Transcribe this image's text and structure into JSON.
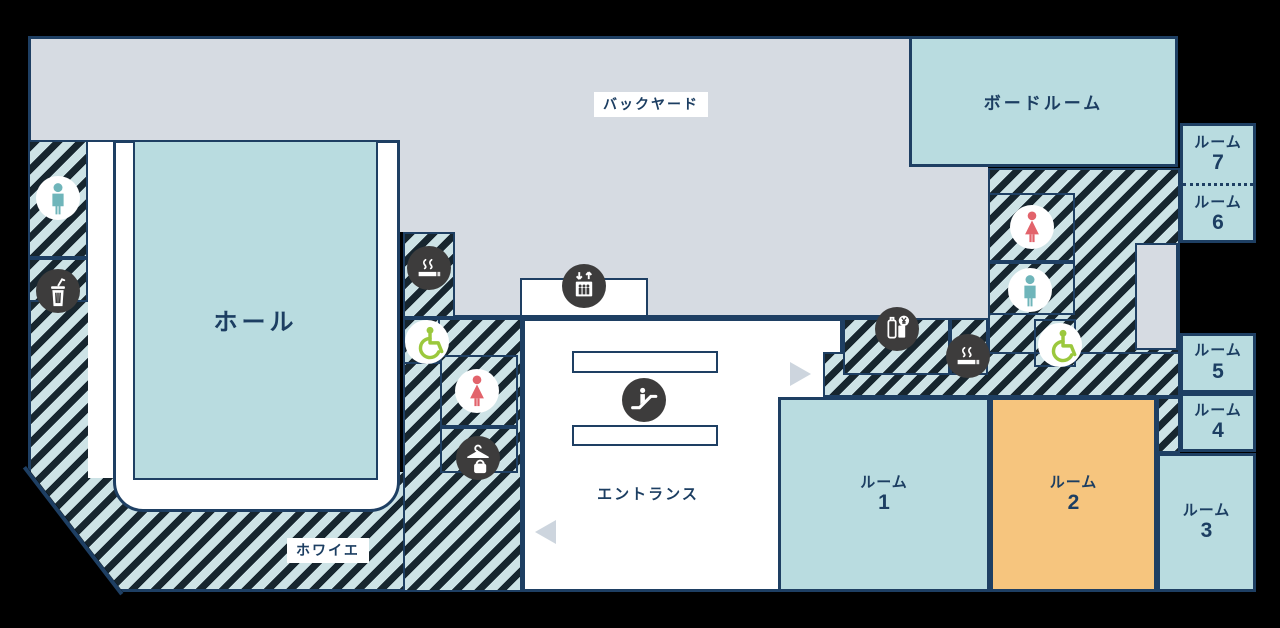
{
  "areas": {
    "backyard": "バックヤード",
    "boardroom": "ボードルーム",
    "hall": "ホール",
    "foyer": "ホワイエ",
    "entrance": "エントランス"
  },
  "rooms": [
    {
      "label": "ルーム",
      "number": "1"
    },
    {
      "label": "ルーム",
      "number": "2"
    },
    {
      "label": "ルーム",
      "number": "3"
    },
    {
      "label": "ルーム",
      "number": "4"
    },
    {
      "label": "ルーム",
      "number": "5"
    },
    {
      "label": "ルーム",
      "number": "6"
    },
    {
      "label": "ルーム",
      "number": "7"
    }
  ],
  "icons": [
    {
      "name": "mens-toilet-icon",
      "glyph": "man-figure",
      "color": "#6fb5ba"
    },
    {
      "name": "womens-toilet-icon",
      "glyph": "woman-figure",
      "color": "#e2636b"
    },
    {
      "name": "accessible-icon",
      "glyph": "wheelchair",
      "color": "#9bc83d"
    },
    {
      "name": "trash-icon",
      "glyph": "trash-can-with-straw",
      "color": "#ffffff"
    },
    {
      "name": "smoking-icon",
      "glyph": "cigarette-with-smoke",
      "color": "#ffffff"
    },
    {
      "name": "vending-machine-icon",
      "glyph": "bottle-can-yen",
      "color": "#ffffff"
    },
    {
      "name": "cloakroom-icon",
      "glyph": "hanger-and-bag",
      "color": "#ffffff"
    },
    {
      "name": "elevator-icon",
      "glyph": "elevator-cab-arrows",
      "color": "#ffffff"
    },
    {
      "name": "escalator-icon",
      "glyph": "escalator-person",
      "color": "#ffffff"
    },
    {
      "name": "arrow-right-icon",
      "glyph": "triangle-right",
      "color": "#cdd5de"
    },
    {
      "name": "arrow-left-icon",
      "glyph": "triangle-left",
      "color": "#cdd5de"
    }
  ],
  "colors": {
    "room_teal": "#b9dce0",
    "room_orange": "#f6c57e",
    "backyard_gray": "#d6dbe2",
    "outline_navy": "#1e3f63",
    "text_navy": "#1c3e62",
    "hatch_light": "#cde3e6",
    "hatch_dark": "#17262f",
    "icon_circle_dark": "#3d3c3c",
    "mens_color": "#6fb5ba",
    "womens_color": "#e2636b",
    "accessible_color": "#9bc83d"
  }
}
